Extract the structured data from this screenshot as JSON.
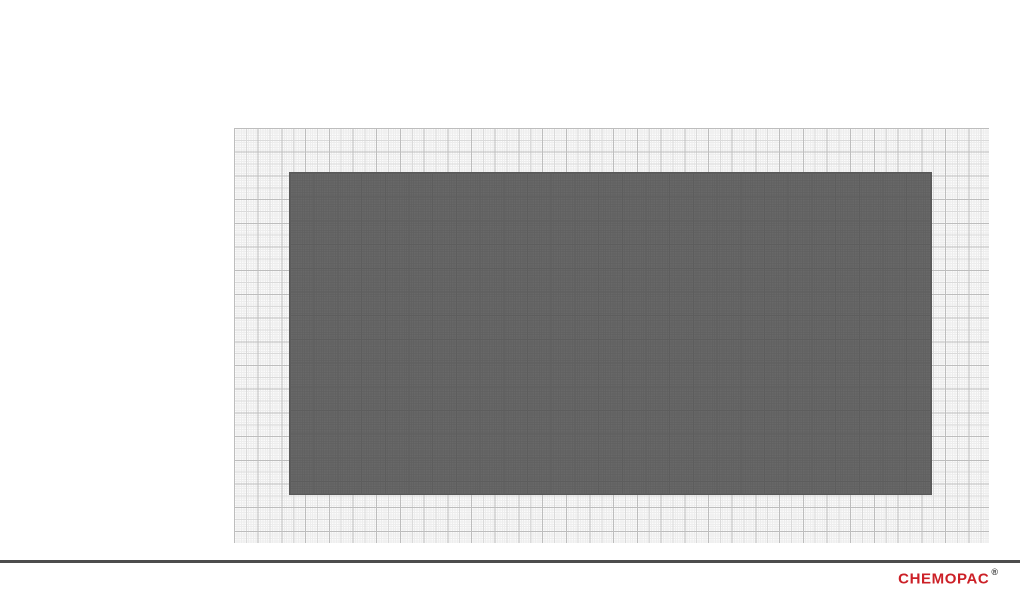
{
  "page": {
    "background_color": "#ffffff"
  },
  "drawing": {
    "graph_paper": {
      "kind": "millimeter-grid",
      "base_color": "#fbfbfb",
      "fine_line_color": "#ededed",
      "medium_line_color": "#dadada",
      "major_line_color": "#bdbdbd",
      "major_step_px": 23.7
    },
    "product_sheet": {
      "fill_color": "#686868",
      "grid_line_color": "#5d5d5d",
      "border_color": "#595959"
    }
  },
  "footer": {
    "rule_color": "#4d4d4d",
    "brand": "CHEMOPAC",
    "brand_color": "#cc2027",
    "registered_mark": "®",
    "registered_color": "#3c3c3c"
  }
}
